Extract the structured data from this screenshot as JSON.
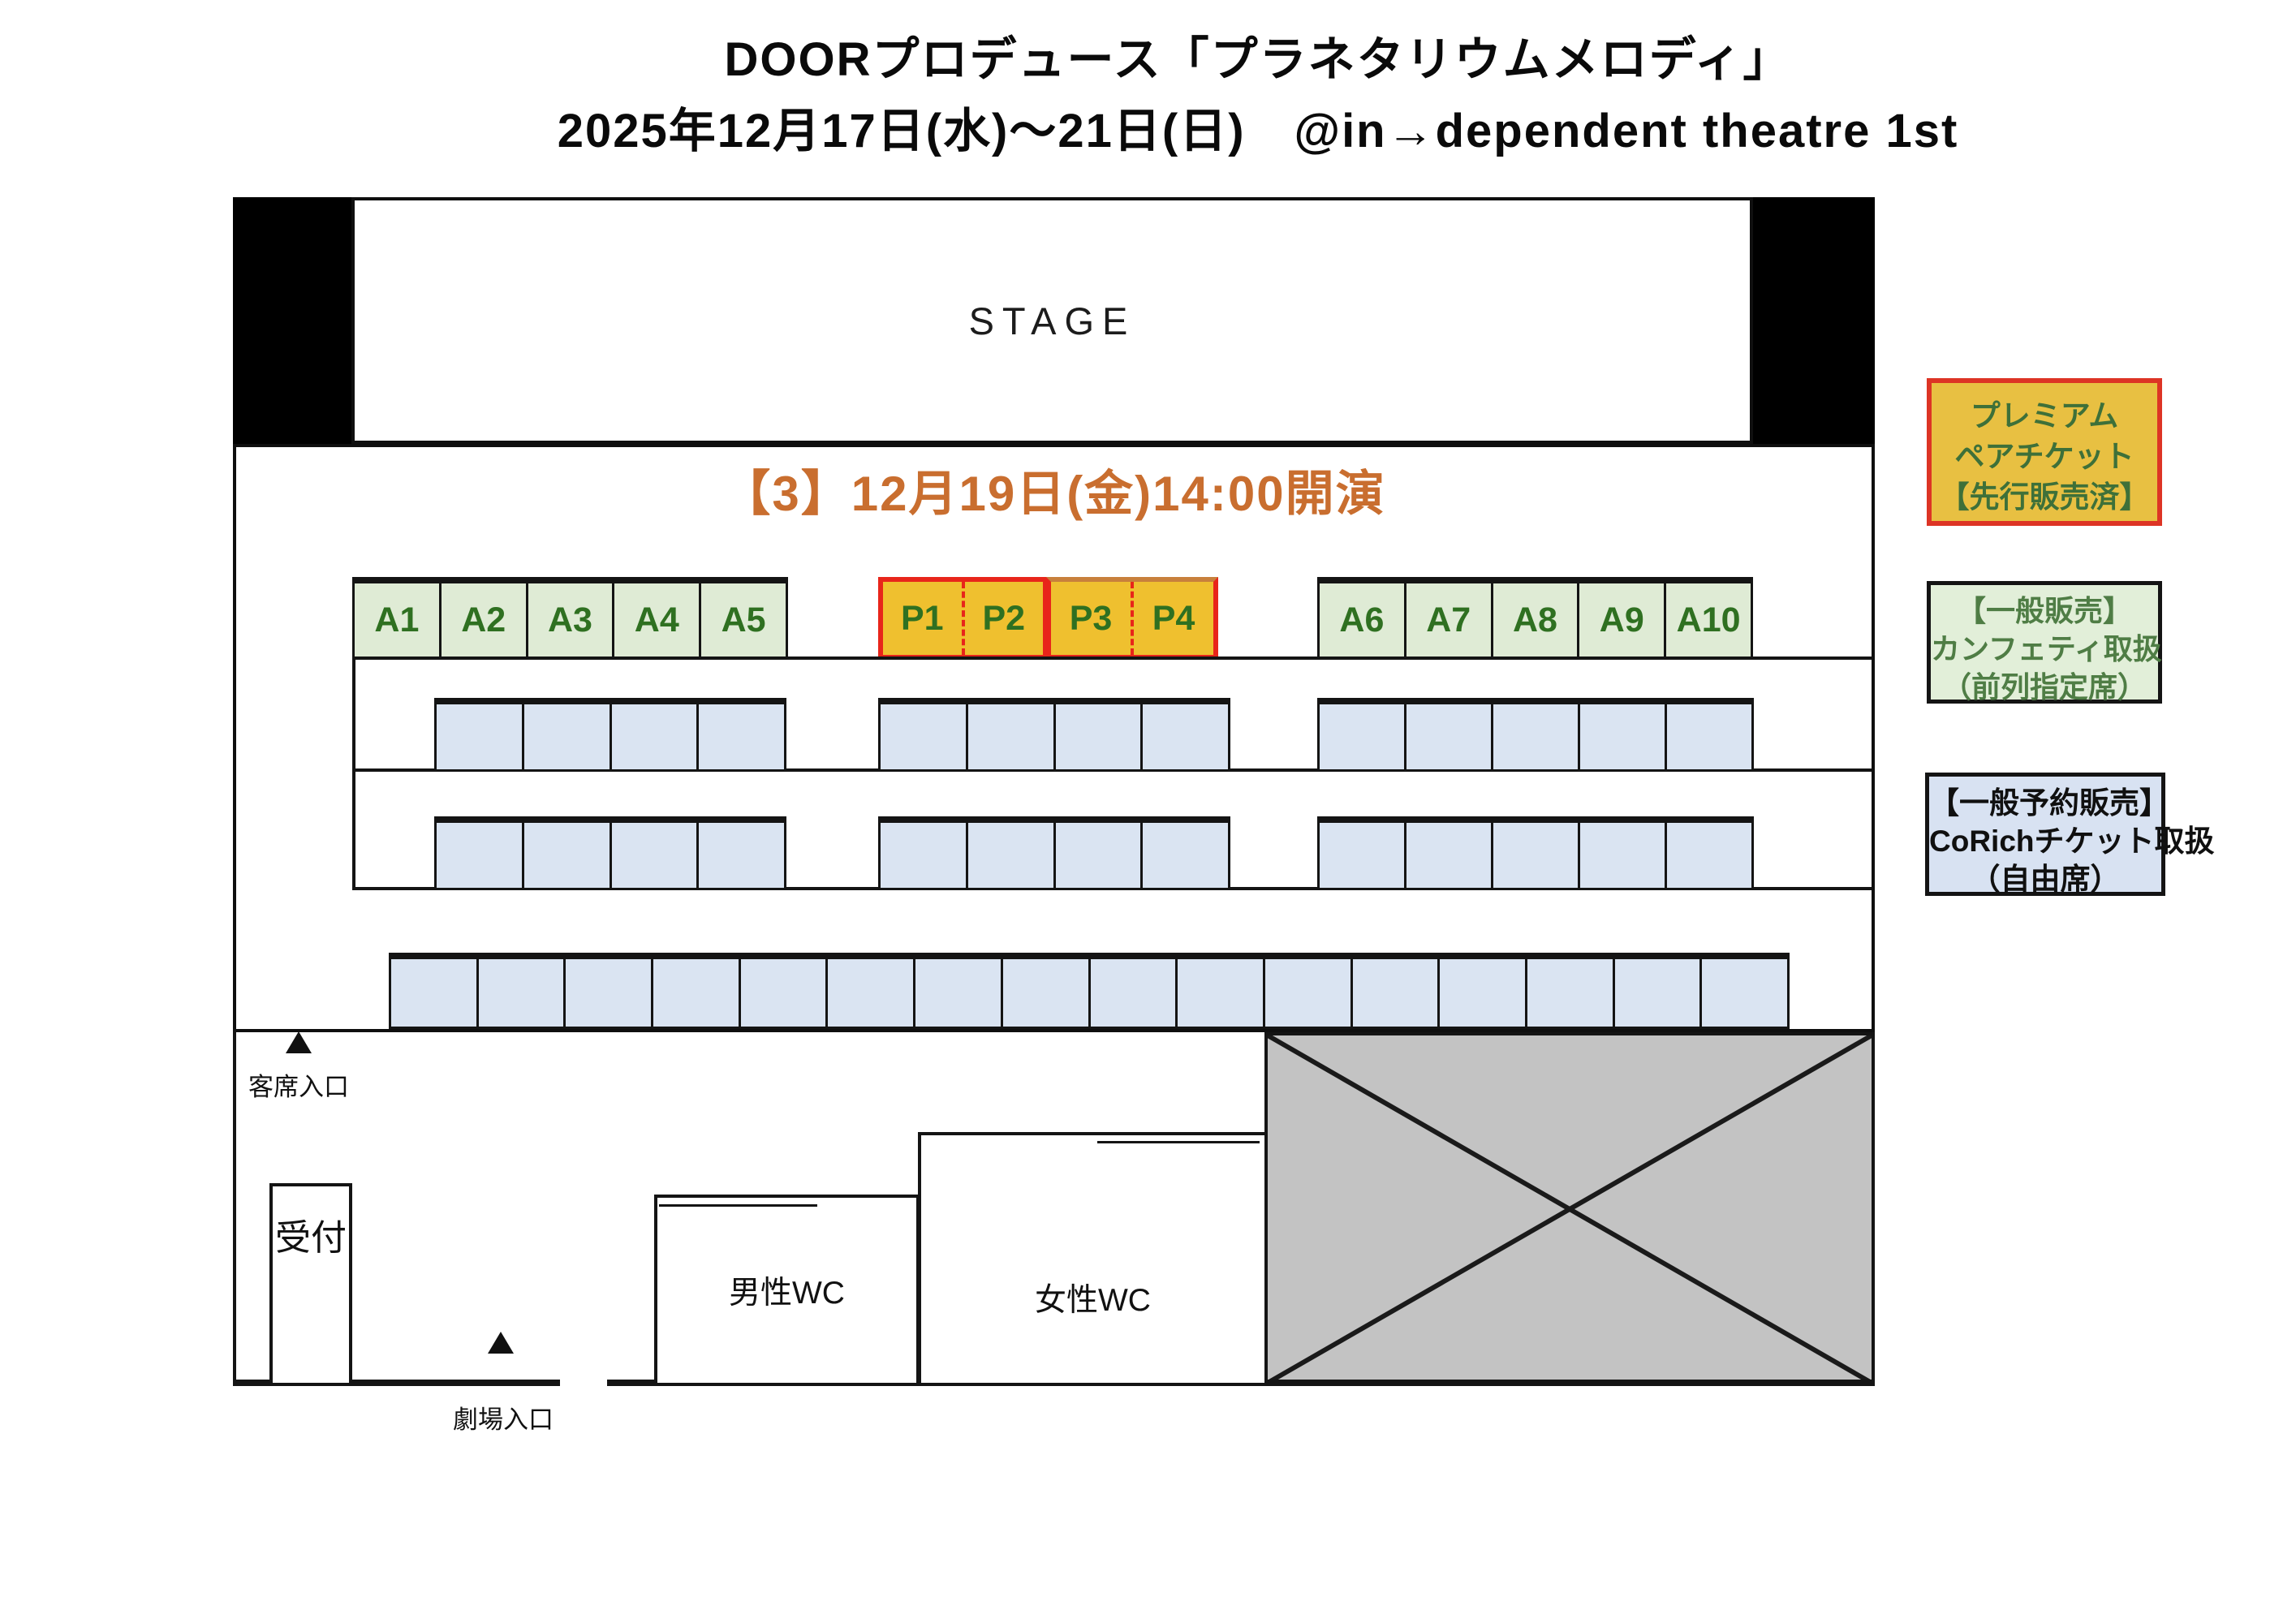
{
  "title": {
    "line1": "DOORプロデュース「プラネタリウムメロディ」",
    "line2": "2025年12月17日(水)〜21日(日)　@in→dependent theatre 1st"
  },
  "stage": {
    "label": "STAGE"
  },
  "session": {
    "label": "【3】12月19日(金)14:00開演"
  },
  "seating": {
    "front_row": {
      "left_green": [
        "A1",
        "A2",
        "A3",
        "A4",
        "A5"
      ],
      "premium": [
        [
          "P1",
          "P2"
        ],
        [
          "P3",
          "P4"
        ]
      ],
      "right_green": [
        "A6",
        "A7",
        "A8",
        "A9",
        "A10"
      ]
    },
    "middle_rows": [
      {
        "groups": [
          4,
          4,
          5
        ]
      },
      {
        "groups": [
          4,
          4,
          5
        ]
      }
    ],
    "back_row": {
      "seat_count": 16
    }
  },
  "lobby": {
    "audience_entrance": "客席入口",
    "theater_entrance": "劇場入口",
    "reception": "受付",
    "mens_wc": "男性WC",
    "womens_wc": "女性WC"
  },
  "legend": [
    {
      "lines": [
        "プレミアム",
        "ペアチケット",
        "【先行販売済】"
      ]
    },
    {
      "lines": [
        "【一般販売】",
        "カンフェティ取扱",
        "（前列指定席）"
      ]
    },
    {
      "lines": [
        "【一般予約販売】",
        "CoRichチケット取扱",
        "（自由席）"
      ]
    }
  ],
  "colors": {
    "session_orange": "#C96E2F",
    "premium_fill": "#EFC02F",
    "premium_border": "#E8251A",
    "premium_top_alt": "#C8803C",
    "reserved_green_fill": "#DFEBD5",
    "seat_label_green": "#2F7021",
    "general_blue_fill": "#DAE4F2",
    "gray_fill": "#C3C3C3",
    "legend_premium_fill": "#E8C042",
    "legend_premium_border": "#DD3425",
    "legend_premium_text": "#3E7039",
    "legend_green_fill": "#E2EFD9",
    "legend_green_text": "#4F7D45",
    "legend_blue_fill": "#D8E2F2"
  }
}
